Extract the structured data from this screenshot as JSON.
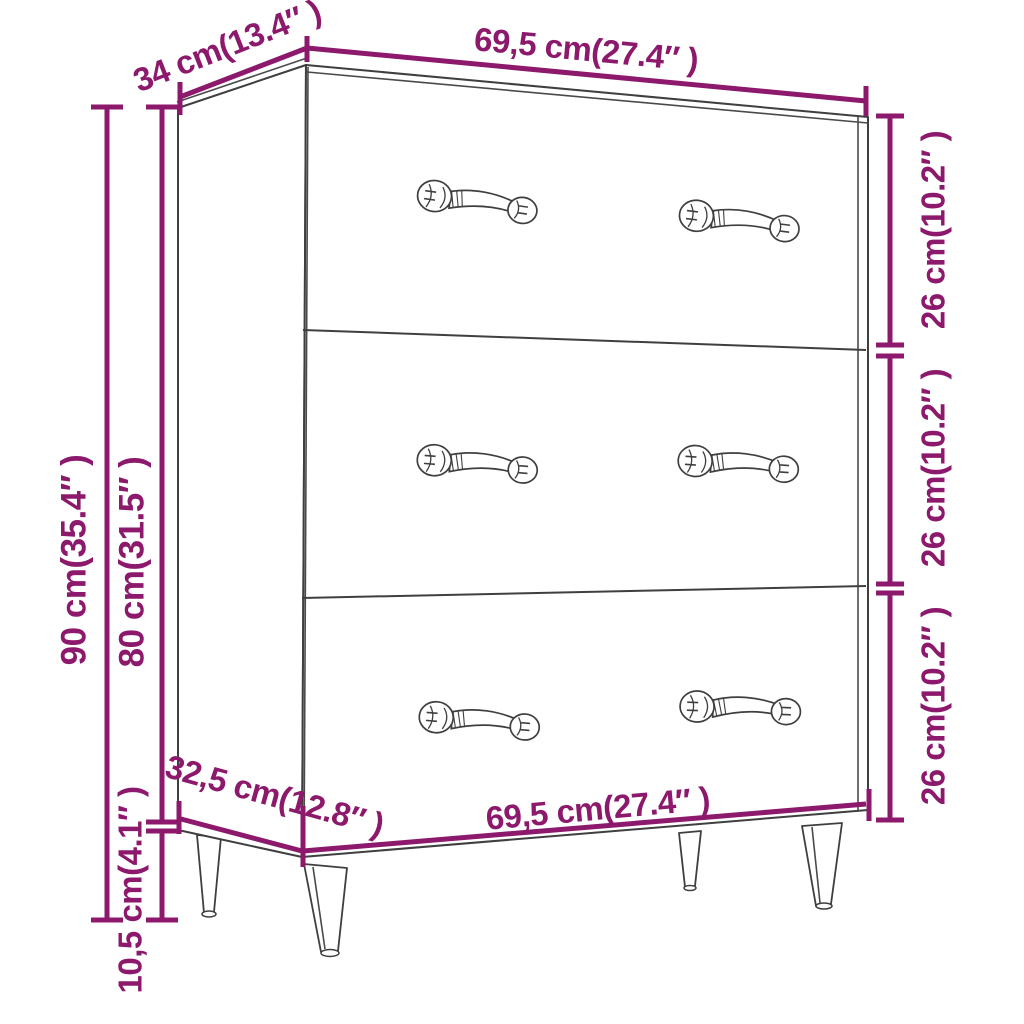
{
  "diagram": {
    "accent_color": "#8C196C",
    "outline_color": "#3F3F3F",
    "background": "#FFFFFF",
    "subject": "sideboard with 3 drawers, line drawing with dimension annotations",
    "labels": {
      "top_depth": "34 cm(13.4″ )",
      "top_width": "69,5 cm(27.4″ )",
      "overall_height": "90 cm(35.4″ )",
      "body_height": "80 cm(31.5″ )",
      "drawer_top_height": "26 cm(10.2″ )",
      "drawer_middle_height": "26 cm(10.2″ )",
      "drawer_bottom_height": "26 cm(10.2″ )",
      "bottom_depth": "32,5 cm(12.8″ )",
      "bottom_width": "69,5 cm(27.4″ )",
      "leg_height": "10,5 cm(4.1″ )"
    }
  }
}
